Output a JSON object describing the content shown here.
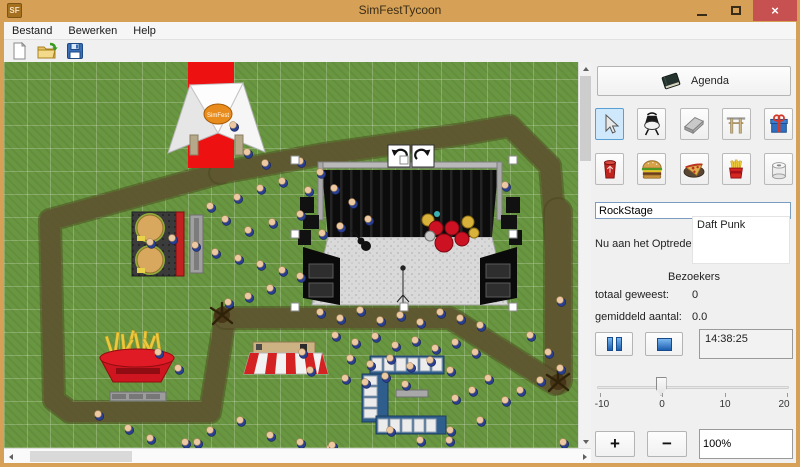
{
  "window": {
    "title": "SimFestTycoon",
    "icon_text": "SF",
    "close_glyph": "×"
  },
  "menu": {
    "items": [
      "Bestand",
      "Bewerken",
      "Help"
    ]
  },
  "toolbar": {
    "buttons": [
      {
        "icon": "new-document-icon"
      },
      {
        "icon": "open-folder-icon"
      },
      {
        "icon": "save-floppy-icon"
      }
    ]
  },
  "panel": {
    "agenda_label": "Agenda",
    "tools": [
      {
        "icon": "select-cursor-icon",
        "selected": true
      },
      {
        "icon": "spotlight-icon",
        "selected": false
      },
      {
        "icon": "path-tile-icon",
        "selected": false
      },
      {
        "icon": "stage-gate-icon",
        "selected": false
      },
      {
        "icon": "gift-icon",
        "selected": false
      },
      {
        "icon": "trash-can-icon",
        "selected": false
      },
      {
        "icon": "hamburger-icon",
        "selected": false
      },
      {
        "icon": "pizza-icon",
        "selected": false
      },
      {
        "icon": "fries-icon",
        "selected": false
      },
      {
        "icon": "toilet-paper-icon",
        "selected": false
      }
    ],
    "stage_name_value": "RockStage",
    "now_playing_label": "Nu aan het Optreden:",
    "now_playing_items": [
      "Daft Punk"
    ],
    "visitors": {
      "header": "Bezoekers",
      "total_label": "totaal geweest:",
      "total_value": "0",
      "average_label": "gemiddeld aantal:",
      "average_value": "0.0"
    },
    "time_value": "14:38:25",
    "zoom_in_label": "+",
    "zoom_out_label": "−",
    "zoom_value": "100%",
    "slider": {
      "min": -10,
      "max": 20,
      "value": 0,
      "ticks": [
        "-10",
        "0",
        "10",
        "20"
      ]
    }
  },
  "canvas": {
    "logo_text": "SimFest",
    "paths": [
      {
        "points": "216,111 46,158 50,338 66,350 206,350 221,256",
        "width": 20
      },
      {
        "points": "216,111 320,92 460,72 506,64 546,104 554,200 554,316",
        "width": 20
      },
      {
        "points": "554,150 554,318",
        "width": 26
      },
      {
        "points": "221,256 446,256 551,322",
        "width": 20
      }
    ],
    "junctions": [
      [
        218,
        253
      ],
      [
        554,
        320
      ]
    ],
    "people": [
      [
        229,
        63
      ],
      [
        243,
        90
      ],
      [
        261,
        101
      ],
      [
        296,
        99
      ],
      [
        316,
        110
      ],
      [
        278,
        119
      ],
      [
        256,
        126
      ],
      [
        233,
        135
      ],
      [
        304,
        128
      ],
      [
        330,
        126
      ],
      [
        348,
        140
      ],
      [
        364,
        157
      ],
      [
        336,
        164
      ],
      [
        318,
        171
      ],
      [
        296,
        152
      ],
      [
        268,
        160
      ],
      [
        244,
        168
      ],
      [
        221,
        157
      ],
      [
        206,
        144
      ],
      [
        191,
        183
      ],
      [
        211,
        190
      ],
      [
        234,
        196
      ],
      [
        256,
        202
      ],
      [
        278,
        208
      ],
      [
        296,
        214
      ],
      [
        266,
        226
      ],
      [
        244,
        234
      ],
      [
        224,
        240
      ],
      [
        146,
        180
      ],
      [
        168,
        176
      ],
      [
        316,
        250
      ],
      [
        336,
        256
      ],
      [
        356,
        248
      ],
      [
        376,
        258
      ],
      [
        396,
        253
      ],
      [
        416,
        260
      ],
      [
        436,
        250
      ],
      [
        456,
        256
      ],
      [
        476,
        263
      ],
      [
        331,
        273
      ],
      [
        351,
        280
      ],
      [
        371,
        274
      ],
      [
        391,
        283
      ],
      [
        411,
        278
      ],
      [
        431,
        286
      ],
      [
        451,
        280
      ],
      [
        471,
        290
      ],
      [
        346,
        296
      ],
      [
        366,
        302
      ],
      [
        386,
        296
      ],
      [
        406,
        304
      ],
      [
        426,
        298
      ],
      [
        446,
        308
      ],
      [
        341,
        316
      ],
      [
        361,
        320
      ],
      [
        381,
        314
      ],
      [
        401,
        322
      ],
      [
        298,
        290
      ],
      [
        306,
        308
      ],
      [
        94,
        352
      ],
      [
        124,
        366
      ],
      [
        146,
        376
      ],
      [
        181,
        380
      ],
      [
        206,
        368
      ],
      [
        236,
        358
      ],
      [
        266,
        373
      ],
      [
        296,
        380
      ],
      [
        326,
        386
      ],
      [
        154,
        290
      ],
      [
        174,
        306
      ],
      [
        501,
        123
      ],
      [
        526,
        273
      ],
      [
        544,
        290
      ],
      [
        556,
        306
      ],
      [
        536,
        318
      ],
      [
        516,
        328
      ],
      [
        501,
        338
      ],
      [
        484,
        316
      ],
      [
        468,
        328
      ],
      [
        451,
        336
      ],
      [
        556,
        238
      ],
      [
        193,
        380
      ],
      [
        328,
        383
      ],
      [
        445,
        378
      ],
      [
        559,
        380
      ],
      [
        386,
        368
      ],
      [
        416,
        378
      ],
      [
        446,
        368
      ],
      [
        476,
        358
      ]
    ]
  },
  "colors": {
    "titlebar": "#d6a156",
    "close_button": "#c75050",
    "grass": "#699640",
    "path": "#5f5730",
    "carpet": "#ee1111",
    "selected_tool_bg": "#cfe8fc"
  }
}
